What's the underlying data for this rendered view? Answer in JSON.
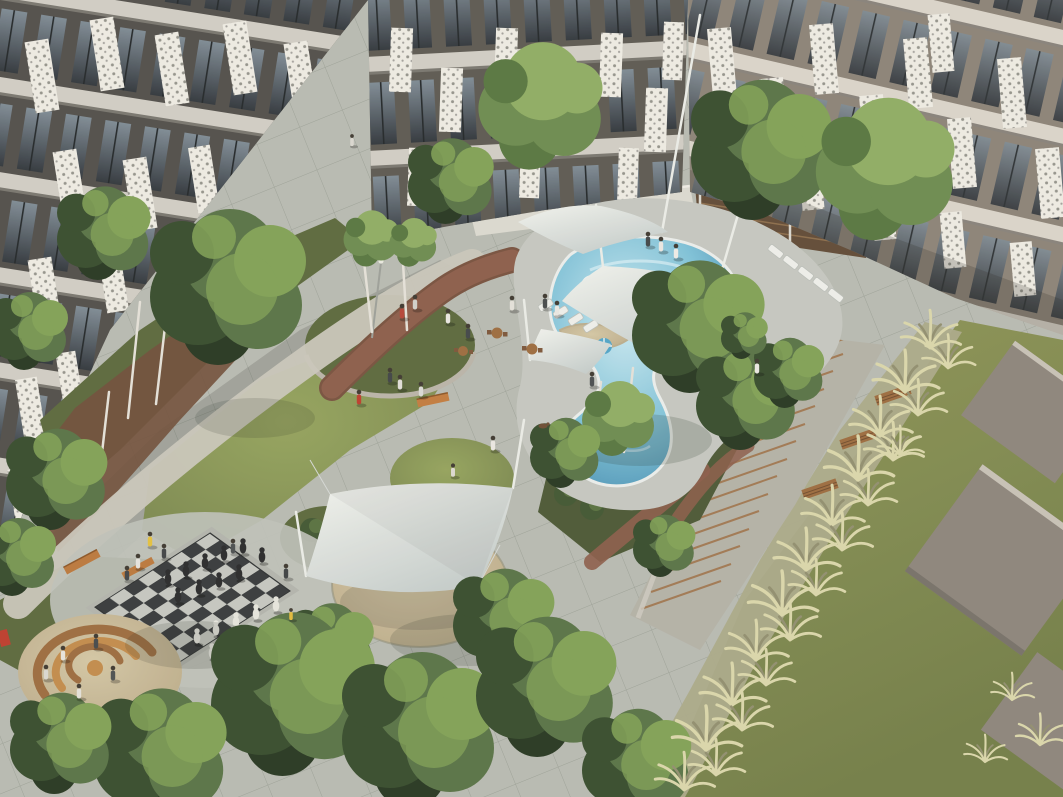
{
  "image": {
    "type": "3d-architectural-rendering",
    "subject": "Aerial view of a landscaped residential courtyard between modern apartment blocks",
    "width_px": 1063,
    "height_px": 797,
    "visible_text": "none"
  },
  "scene": {
    "buildings": {
      "left": "apartment wing, dark grey facade, full-height glass balconies, white perforated lattice screen panels, light concrete floor bands, planted balconies",
      "top": "apartment wing facing courtyard, same facade system, white ground-floor terrace wall with railing",
      "right": "apartment wing in warm taupe tone receding to the right edge, perforated white panels over glazing"
    },
    "courtyard": {
      "pool": "free-form curvy swimming pool, turquoise water, light concrete deck, tan curved seating wall island, white sun loungers, pool umbrellas",
      "shade_sails": "white tensile fabric canopies on slim masts: three over the pool terrace, one large four-point sail over a sand circle",
      "chess_terrace": "giant outdoor chess board, dark and light paving squares with oversized black and white pieces, spectators, timber bench",
      "sand_play_circle": "sand pit with concentric curved timber benches, children and adults",
      "planter": "raised circular stone planter with birch trees",
      "grass_mound": "circular lawn mound with kneeling person",
      "shrub_circle": "round clipped shrub bed beside the big sail",
      "topiary_garden": "shaded garden of clipped shrub balls and birches below the pool",
      "paths": "light gravel walk along the left building, winding red clay-brick path, large grey concrete paver plaza",
      "stairs": "long garden staircase with timber step edges and slatted timber benches descending along the right side",
      "tall_grass_slope": "diagonal band of pale ornamental pampas grasses",
      "lawn": "sloped olive-green lawn, upper right, with two large tilted concrete slabs",
      "street_furniture": "orange timber benches, small wooden cafe tables and chairs, lamp post, red play element",
      "trees": "many deciduous trees with white birch trunks framing the courtyard and bottom edge"
    },
    "counts": {
      "shade_sails": 4,
      "pool_umbrellas": 2,
      "sun_loungers": 9,
      "stair_steps": 15,
      "timber_benches_on_stairs": 3,
      "concrete_slabs_on_lawn": 3,
      "chess_board": "8x8",
      "chess_pieces_visible": 20,
      "people_approx": 31,
      "cafe_tables": 3
    },
    "lighting": "soft daylight from upper left, long soft shadows toward lower right"
  },
  "palette": {
    "wall_dark": "#4e4c49",
    "wall_mid": "#5a5751",
    "wall_taupe": "#8a8176",
    "band_light": "#cfccc4",
    "glass_dark": "#2e343b",
    "glass_light": "#7c8994",
    "panel_white": "#eceae3",
    "pavement": "#b6b9b1",
    "pavement_line": "#798079",
    "shadow_green": "#2c342e",
    "water_light": "#c9e8f1",
    "water_mid": "#7cc0d8",
    "water_deep": "#3d87ac",
    "deck": "#c3c6c0",
    "pool_edge": "#e9edeb",
    "sail": "#f0f2ee",
    "sail_dark": "#c3cbca",
    "grass": "#75834d",
    "grass_light": "#93a25c",
    "grass_dark": "#59673c",
    "garden_shade": "#495634",
    "shrub": "#3f5531",
    "lawn": "#8d9557",
    "lawn_dark": "#707c46",
    "tallgrass": "#a9a888",
    "tuft_light": "#d8d5aa",
    "tuft_dark": "#8f8d6e",
    "sand": "#d2c5a4",
    "sand_dark": "#b7a887",
    "wood": "#9a6a3e",
    "wood_light": "#c08a4a",
    "brick": "#8a5b49",
    "brick_dark": "#75503e",
    "slab": "#8b837b",
    "slab_edge": "#d5cfc6",
    "chess_dark": "#34373a",
    "chess_light": "#c3c6c0",
    "tree": "#567145",
    "tree_light": "#7fa055",
    "tree_dark": "#344a2c",
    "tree_deep": "#243520",
    "treeL_a": "#6a8a4e",
    "treeL_b": "#8dab62",
    "treeL_c": "#55743f",
    "trunk": "#e3e0d8",
    "umbrella_blue": "#4fa3c8",
    "accent_red": "#bb3a2c",
    "accent_yellow": "#e2bf3e",
    "person_dark": "#3b3f42",
    "person_light": "#e6e4df"
  }
}
